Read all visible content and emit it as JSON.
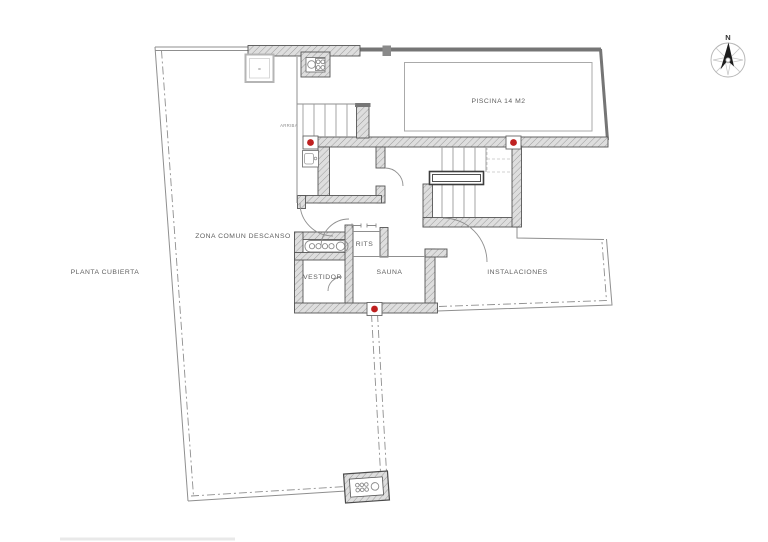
{
  "drawing": {
    "title": "PLANTA CUBIERTA",
    "type": "architectural roof floor plan"
  },
  "labels": {
    "plan_title": "PLANTA CUBIERTA",
    "zona_comun": "ZONA COMUN DESCANSO",
    "piscina": "PISCINA 14 M2",
    "arriba": "ARRIBA",
    "rits": "RITS",
    "vestidor": "VESTIDOR",
    "sauna": "SAUNA",
    "instalaciones": "INSTALACIONES",
    "north": "N",
    "skylight_mark": "="
  },
  "colors": {
    "background": "#ffffff",
    "wall_fill": "#dedede",
    "wall_hatch": "#9b9b9b",
    "wall_edge": "#555555",
    "boundary_line": "#8f8f8f",
    "pool_wall": "#757575",
    "red_marker": "#bf2020",
    "text": "#5f5f5f"
  },
  "markers": {
    "red_dot_count": 3
  }
}
